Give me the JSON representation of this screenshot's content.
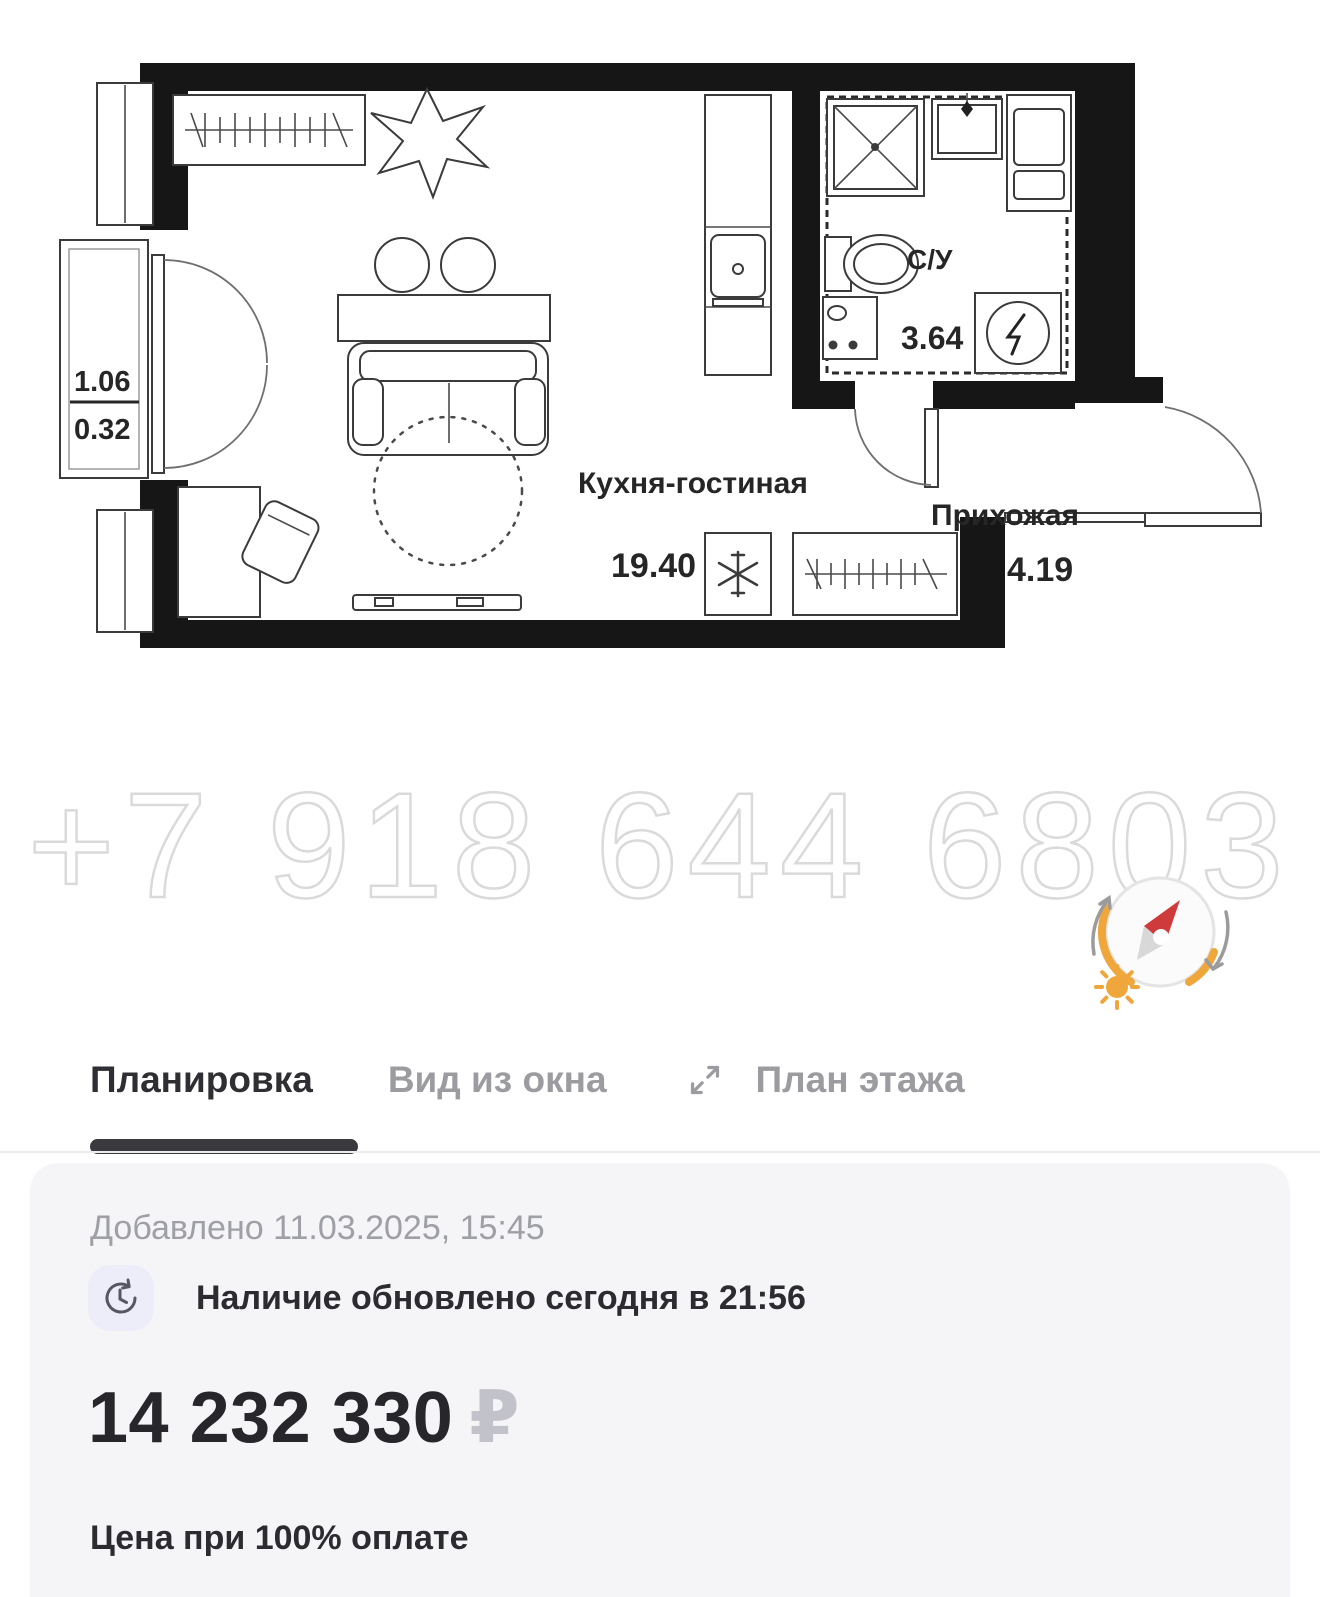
{
  "plan": {
    "watermark": "+7 918 644 6803",
    "rooms": {
      "living": {
        "label": "Кухня-гостиная",
        "area": "19.40"
      },
      "hall": {
        "label": "Прихожая",
        "area": "4.19"
      },
      "bath": {
        "label": "С/У",
        "area": "3.64"
      }
    },
    "balcony": {
      "upper": "1.06",
      "lower": "0.32"
    }
  },
  "tabs": {
    "layout": "Планировка",
    "window_view": "Вид из окна",
    "floor_plan": "План этажа"
  },
  "card": {
    "added": "Добавлено 11.03.2025, 15:45",
    "availability": "Наличие обновлено сегодня в 21:56",
    "price": "14 232 330",
    "currency": "₽",
    "payment_note": "Цена при 100% оплате"
  },
  "colors": {
    "accent_orange": "#EFA63B",
    "needle_red": "#CF3A3A",
    "card_bg": "#F5F5F7",
    "muted_text": "#9FA0A6",
    "dark_text": "#2B2B30",
    "tab_inactive": "#9B9BA0",
    "active_tab_bar": "#3A3A3E"
  }
}
